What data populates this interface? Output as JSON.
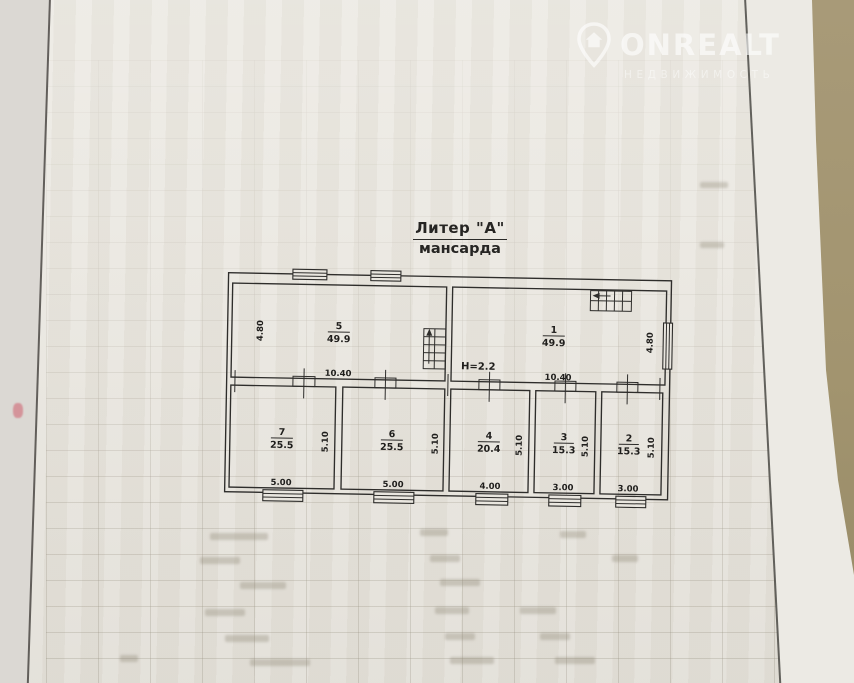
{
  "watermark": {
    "brand": "ONREALT",
    "tagline": "НЕДВИЖИМОСТЬ",
    "logo": "house-pin-icon"
  },
  "plan": {
    "title": "Литер \"А\"",
    "subtitle": "мансарда",
    "height_note": "Н=2.2",
    "upper_rooms": [
      {
        "number": "5",
        "area": "49.9",
        "side_dim": "4.80",
        "width_dim": "10.40"
      },
      {
        "number": "1",
        "area": "49.9",
        "side_dim": "4.80",
        "width_dim": "10.40"
      }
    ],
    "lower_rooms": [
      {
        "number": "7",
        "area": "25.5",
        "depth_dim": "5.10",
        "width_dim": "5.00"
      },
      {
        "number": "6",
        "area": "25.5",
        "depth_dim": "5.10",
        "width_dim": "5.00"
      },
      {
        "number": "4",
        "area": "20.4",
        "depth_dim": "5.10",
        "width_dim": "4.00"
      },
      {
        "number": "3",
        "area": "15.3",
        "depth_dim": "5.10",
        "width_dim": "3.00"
      },
      {
        "number": "2",
        "area": "15.3",
        "depth_dim": "5.10",
        "width_dim": "3.00"
      }
    ]
  },
  "colors": {
    "paper": "#e9e6df",
    "ink": "#2e2d2b",
    "table_surface": "#a2946f",
    "watermark": "rgba(255,255,255,0.6)"
  }
}
